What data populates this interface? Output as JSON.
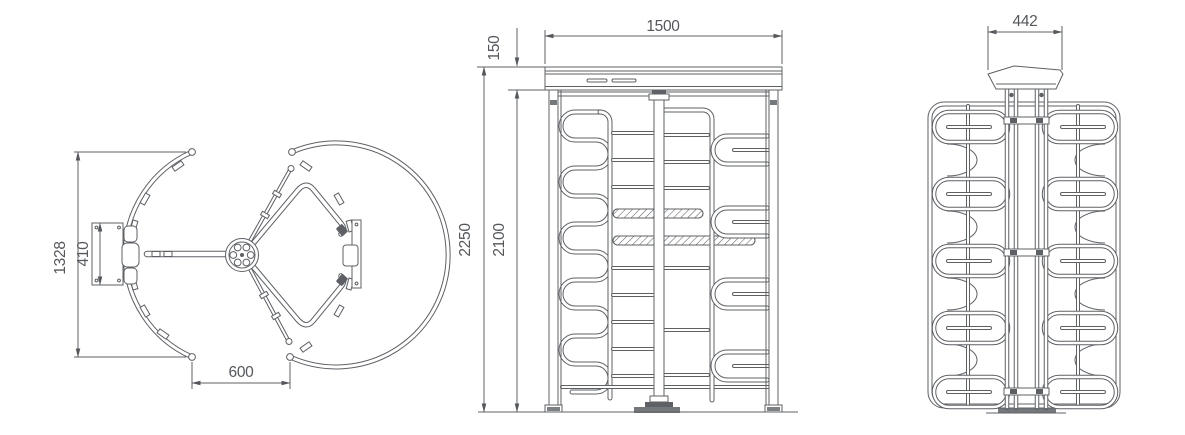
{
  "views": {
    "plan": {
      "name": "top-view",
      "dims": {
        "overall": "1328",
        "gate": "410",
        "passage": "600"
      }
    },
    "front": {
      "name": "front-view",
      "dims": {
        "width": "1500",
        "canopy": "150",
        "height_total": "2250",
        "height_frame": "2100"
      }
    },
    "side": {
      "name": "side-view",
      "dims": {
        "head_width": "442"
      }
    }
  },
  "colors": {
    "line": "#5d6064",
    "text": "#54575b",
    "background": "#ffffff"
  }
}
